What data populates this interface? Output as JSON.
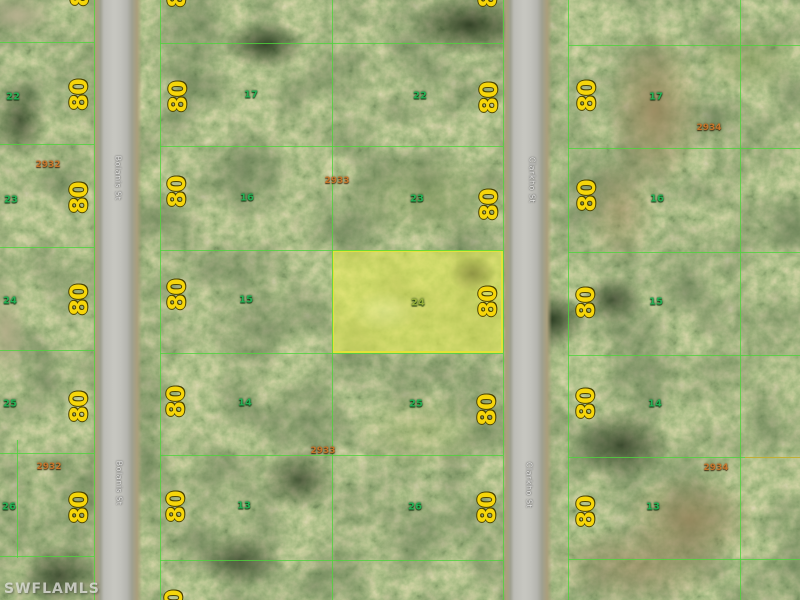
{
  "map": {
    "watermark": "SWFLAMLS",
    "dim_value": "80",
    "highlight": {
      "lot": "24",
      "x": 332,
      "y": 250,
      "w": 171,
      "h": 103,
      "label_x": 418,
      "label_y": 303
    },
    "streets": [
      {
        "t": "Bolanis St",
        "x": 118,
        "y": 178
      },
      {
        "t": "Bolanis St",
        "x": 119,
        "y": 483
      },
      {
        "t": "Clarkho St",
        "x": 532,
        "y": 180
      },
      {
        "t": "Clarkho St",
        "x": 529,
        "y": 485
      }
    ],
    "blocks": [
      {
        "t": "2932",
        "x": 48,
        "y": 165
      },
      {
        "t": "2932",
        "x": 49,
        "y": 467
      },
      {
        "t": "2933",
        "x": 337,
        "y": 181
      },
      {
        "t": "2933",
        "x": 323,
        "y": 451
      },
      {
        "t": "2934",
        "x": 709,
        "y": 128
      },
      {
        "t": "2934",
        "x": 716,
        "y": 468
      }
    ],
    "lots": [
      {
        "t": "22",
        "x": 13,
        "y": 97
      },
      {
        "t": "23",
        "x": 11,
        "y": 200
      },
      {
        "t": "24",
        "x": 10,
        "y": 301
      },
      {
        "t": "25",
        "x": 10,
        "y": 404
      },
      {
        "t": "26",
        "x": 9,
        "y": 507
      },
      {
        "t": "17",
        "x": 251,
        "y": 95
      },
      {
        "t": "16",
        "x": 247,
        "y": 198
      },
      {
        "t": "15",
        "x": 246,
        "y": 300
      },
      {
        "t": "14",
        "x": 245,
        "y": 403
      },
      {
        "t": "13",
        "x": 244,
        "y": 506
      },
      {
        "t": "22",
        "x": 420,
        "y": 96
      },
      {
        "t": "23",
        "x": 417,
        "y": 199
      },
      {
        "t": "25",
        "x": 416,
        "y": 404
      },
      {
        "t": "26",
        "x": 415,
        "y": 507
      },
      {
        "t": "17",
        "x": 656,
        "y": 97
      },
      {
        "t": "16",
        "x": 657,
        "y": 199
      },
      {
        "t": "15",
        "x": 656,
        "y": 302
      },
      {
        "t": "14",
        "x": 655,
        "y": 404
      },
      {
        "t": "13",
        "x": 653,
        "y": 507
      }
    ],
    "dims": [
      {
        "t": "80",
        "x": 80,
        "y": -9
      },
      {
        "t": "80",
        "x": 79,
        "y": 95
      },
      {
        "t": "80",
        "x": 79,
        "y": 198
      },
      {
        "t": "80",
        "x": 79,
        "y": 300
      },
      {
        "t": "80",
        "x": 79,
        "y": 407
      },
      {
        "t": "80",
        "x": 79,
        "y": 508
      },
      {
        "t": "80",
        "x": 177,
        "y": -8
      },
      {
        "t": "80",
        "x": 178,
        "y": 97
      },
      {
        "t": "80",
        "x": 177,
        "y": 192
      },
      {
        "t": "80",
        "x": 177,
        "y": 295
      },
      {
        "t": "80",
        "x": 176,
        "y": 402
      },
      {
        "t": "80",
        "x": 176,
        "y": 507
      },
      {
        "t": "80",
        "x": 174,
        "y": 606
      },
      {
        "t": "80",
        "x": 488,
        "y": -8
      },
      {
        "t": "80",
        "x": 489,
        "y": 98
      },
      {
        "t": "80",
        "x": 489,
        "y": 205
      },
      {
        "t": "80",
        "x": 488,
        "y": 302
      },
      {
        "t": "80",
        "x": 487,
        "y": 410
      },
      {
        "t": "80",
        "x": 487,
        "y": 508
      },
      {
        "t": "80",
        "x": 587,
        "y": 96
      },
      {
        "t": "80",
        "x": 587,
        "y": 196
      },
      {
        "t": "80",
        "x": 586,
        "y": 303
      },
      {
        "t": "80",
        "x": 586,
        "y": 404
      },
      {
        "t": "80",
        "x": 586,
        "y": 512
      }
    ],
    "boundaries": [
      {
        "x": 94,
        "y": 0,
        "w": 1,
        "h": 600
      },
      {
        "x": 160,
        "y": 0,
        "w": 1,
        "h": 600
      },
      {
        "x": 332,
        "y": 0,
        "w": 1,
        "h": 600
      },
      {
        "x": 503,
        "y": 0,
        "w": 1,
        "h": 600
      },
      {
        "x": 568,
        "y": 0,
        "w": 1,
        "h": 600
      },
      {
        "x": 740,
        "y": 0,
        "w": 1,
        "h": 600
      },
      {
        "x": 17,
        "y": 440,
        "w": 1,
        "h": 118
      },
      {
        "x": 0,
        "y": 42,
        "w": 94,
        "h": 1
      },
      {
        "x": 0,
        "y": 144,
        "w": 94,
        "h": 1
      },
      {
        "x": 0,
        "y": 247,
        "w": 94,
        "h": 1
      },
      {
        "x": 0,
        "y": 350,
        "w": 94,
        "h": 1
      },
      {
        "x": 0,
        "y": 453,
        "w": 94,
        "h": 1
      },
      {
        "x": 0,
        "y": 556,
        "w": 94,
        "h": 1
      },
      {
        "x": 160,
        "y": 43,
        "w": 343,
        "h": 1
      },
      {
        "x": 160,
        "y": 146,
        "w": 343,
        "h": 1
      },
      {
        "x": 160,
        "y": 250,
        "w": 343,
        "h": 1
      },
      {
        "x": 160,
        "y": 353,
        "w": 343,
        "h": 1
      },
      {
        "x": 160,
        "y": 455,
        "w": 343,
        "h": 1
      },
      {
        "x": 160,
        "y": 560,
        "w": 343,
        "h": 1
      },
      {
        "x": 568,
        "y": 45,
        "w": 232,
        "h": 1
      },
      {
        "x": 568,
        "y": 148,
        "w": 232,
        "h": 1
      },
      {
        "x": 568,
        "y": 252,
        "w": 232,
        "h": 1
      },
      {
        "x": 568,
        "y": 355,
        "w": 232,
        "h": 1
      },
      {
        "x": 568,
        "y": 457,
        "w": 232,
        "h": 1
      },
      {
        "x": 568,
        "y": 559,
        "w": 232,
        "h": 1
      },
      {
        "x": 745,
        "y": 457,
        "w": 55,
        "h": 1,
        "c": "#d8a82e"
      }
    ]
  },
  "colors": {
    "boundary_line": "#4ed43c",
    "highlight_fill": "rgba(228,235,85,0.6)",
    "highlight_border": "#e3e23a",
    "highlight_lot_text": "#96b03a",
    "dim_text": "#f6d60a",
    "lot_text": "#23b054",
    "block_text": "#c6762c",
    "street_text": "#ededea",
    "watermark_text": "rgba(235,235,232,0.72)"
  }
}
